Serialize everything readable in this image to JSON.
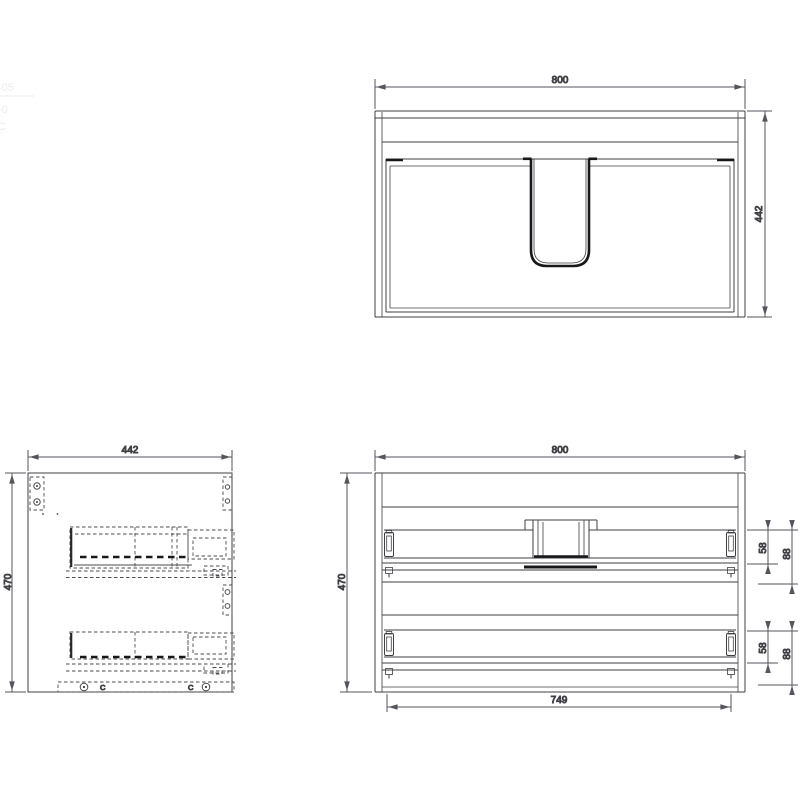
{
  "drawing_title": "vanity-cabinet-three-view-technical-drawing",
  "colors": {
    "line": "#3f3f46",
    "dim": "#55555e",
    "heavy": "#18181b",
    "hidden": "#4b4b52",
    "faint": "#ebebeb",
    "background": "#ffffff"
  },
  "views": {
    "plan": {
      "dim_width": "800",
      "dim_depth": "442"
    },
    "side": {
      "dim_width": "442",
      "dim_height": "470",
      "marker_left": "C",
      "marker_right": "C"
    },
    "rear": {
      "dim_width": "800",
      "dim_height": "470",
      "dim_inner_width": "749",
      "upper_rail": {
        "dim_height": "58",
        "dim_offset": "88"
      },
      "lower_rail": {
        "dim_height": "58",
        "dim_offset": "88"
      }
    }
  },
  "edge_fragments": {
    "f1": "-05",
    "f2": "-0",
    "f3": "C"
  }
}
